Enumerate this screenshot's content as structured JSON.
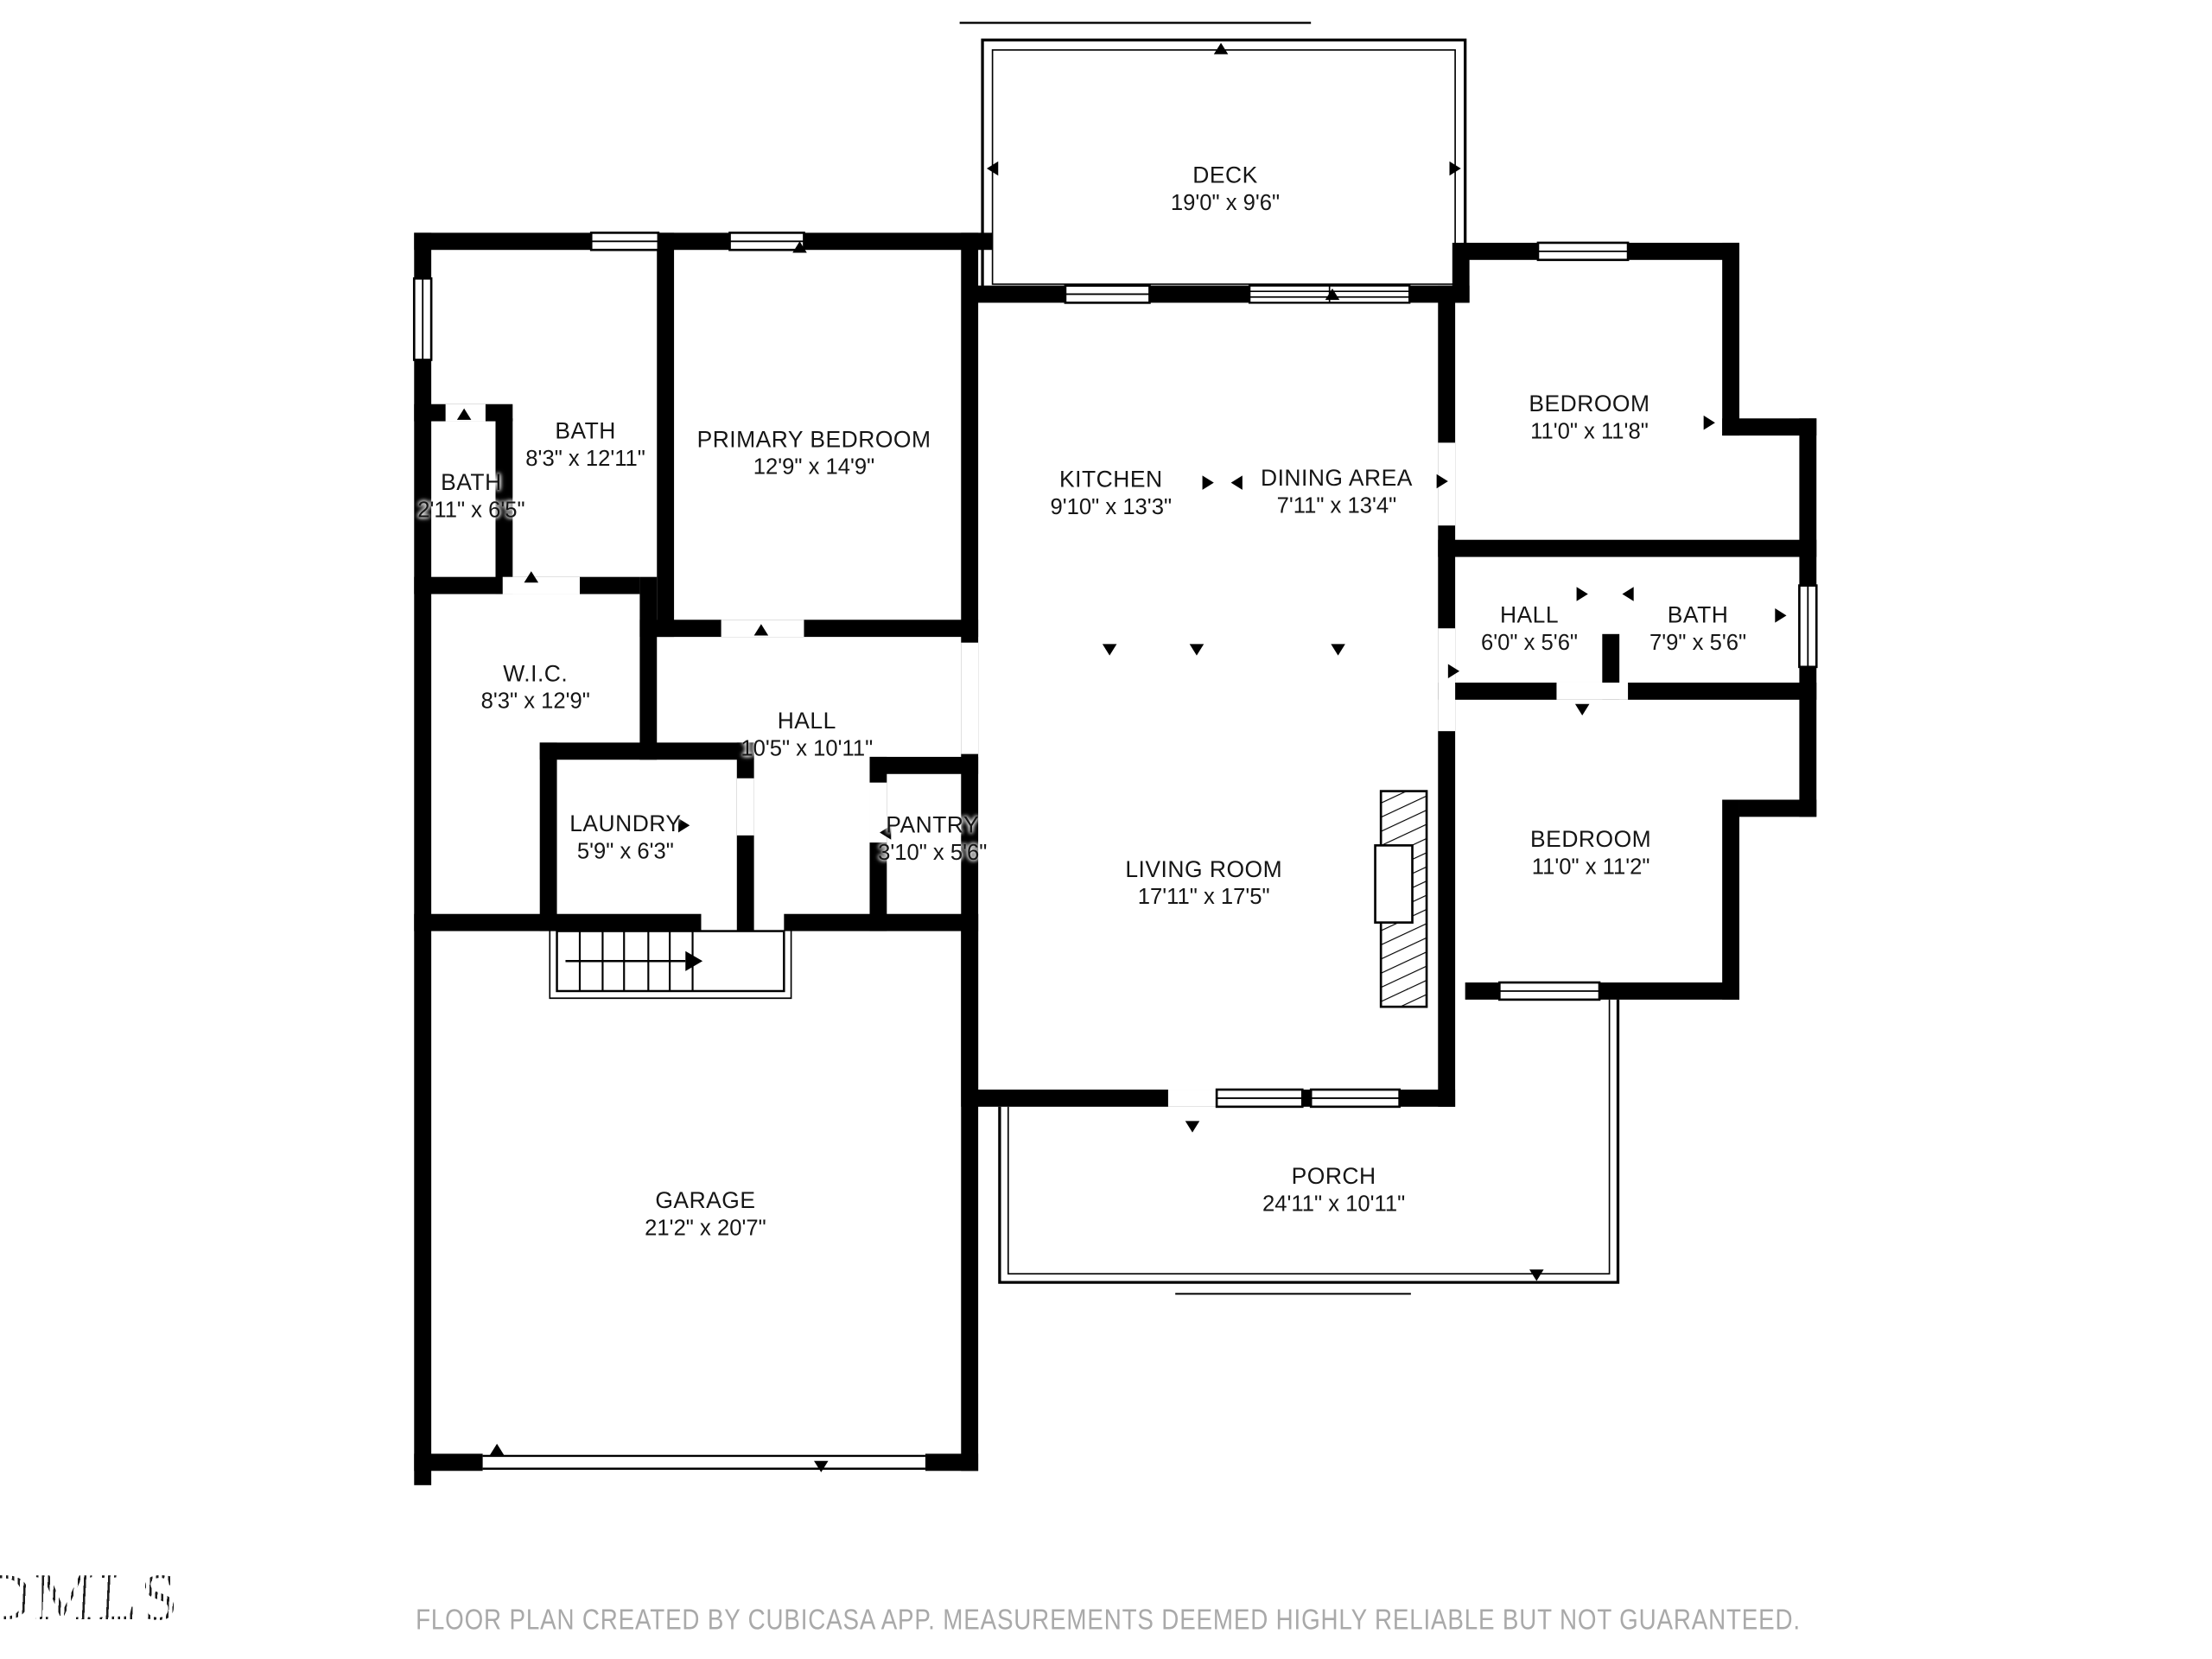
{
  "page": {
    "background": "#ffffff"
  },
  "colors": {
    "wall": "#000000",
    "label_text": "#151515",
    "disclaimer_text": "#a9a9a9"
  },
  "icons": {
    "door_swing_marker": "▲",
    "stair_direction_marker": "→",
    "window_symbol": "double-line-rect",
    "fireplace_symbol": "diagonal-hatch-rect"
  },
  "rooms": {
    "deck": {
      "name": "DECK",
      "dims": "19'0\" x 9'6\""
    },
    "bath_main": {
      "name": "BATH",
      "dims": "8'3\" x 12'11\""
    },
    "bath_small": {
      "name": "BATH",
      "dims": "2'11\" x 6'5\""
    },
    "primary_bedroom": {
      "name": "PRIMARY BEDROOM",
      "dims": "12'9\" x 14'9\""
    },
    "kitchen": {
      "name": "KITCHEN",
      "dims": "9'10\" x 13'3\""
    },
    "dining_area": {
      "name": "DINING AREA",
      "dims": "7'11\" x 13'4\""
    },
    "bedroom_top": {
      "name": "BEDROOM",
      "dims": "11'0\" x 11'8\""
    },
    "hall_right": {
      "name": "HALL",
      "dims": "6'0\" x 5'6\""
    },
    "bath_right": {
      "name": "BATH",
      "dims": "7'9\" x 5'6\""
    },
    "wic": {
      "name": "W.I.C.",
      "dims": "8'3\" x 12'9\""
    },
    "hall_center": {
      "name": "HALL",
      "dims": "10'5\" x 10'11\""
    },
    "laundry": {
      "name": "LAUNDRY",
      "dims": "5'9\" x 6'3\""
    },
    "pantry": {
      "name": "PANTRY",
      "dims": "3'10\" x 5'6\""
    },
    "living_room": {
      "name": "LIVING ROOM",
      "dims": "17'11\" x 17'5\""
    },
    "bedroom_right": {
      "name": "BEDROOM",
      "dims": "11'0\" x 11'2\""
    },
    "garage": {
      "name": "GARAGE",
      "dims": "21'2\" x 20'7\""
    },
    "porch": {
      "name": "PORCH",
      "dims": "24'11\" x 10'11\""
    }
  },
  "footer": {
    "disclaimer": "FLOOR PLAN CREATED BY CUBICASA APP. MEASUREMENTS DEEMED HIGHLY RELIABLE BUT NOT GUARANTEED.",
    "logo_text": "DMLS"
  }
}
